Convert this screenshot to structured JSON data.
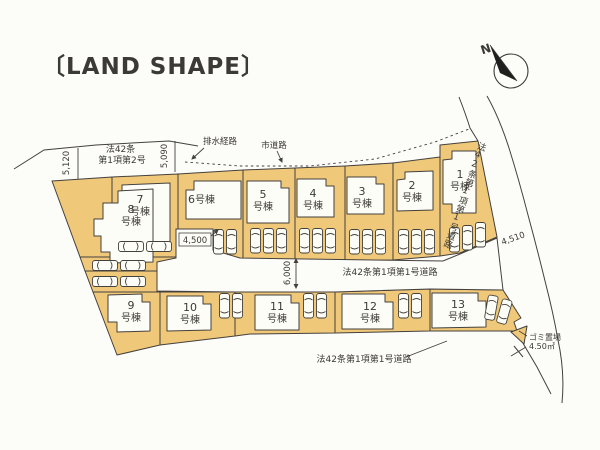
{
  "title": "〔LAND SHAPE〕",
  "compass": {
    "north": "N"
  },
  "roads": {
    "top_law_line1": "法42条",
    "top_law_line2": "第1項第2号",
    "drainage": "排水経路",
    "city_road": "市道路",
    "right_road": "法42条第1項第1号道路",
    "middle_road": "法42条第1項第1号道路",
    "bottom_road": "法42条第1項第1号道路"
  },
  "dimensions": {
    "top_left": "5,120",
    "top_mid": "5,090",
    "mid_left": "4,500",
    "right_junction": "4,510",
    "middle_road_width": "6,000"
  },
  "garbage": {
    "name": "ゴミ置場",
    "area": "4.50㎡"
  },
  "plots": [
    {
      "num": "1",
      "suffix": "号棟"
    },
    {
      "num": "2",
      "suffix": "号棟"
    },
    {
      "num": "3",
      "suffix": "号棟"
    },
    {
      "num": "4",
      "suffix": "号棟"
    },
    {
      "num": "5",
      "suffix": "号棟"
    },
    {
      "num": "6",
      "suffix": "号棟"
    },
    {
      "num": "7",
      "suffix": "号棟"
    },
    {
      "num": "8",
      "suffix": "号棟"
    },
    {
      "num": "9",
      "suffix": "号棟"
    },
    {
      "num": "10",
      "suffix": "号棟"
    },
    {
      "num": "11",
      "suffix": "号棟"
    },
    {
      "num": "12",
      "suffix": "号棟"
    },
    {
      "num": "13",
      "suffix": "号棟"
    }
  ],
  "colors": {
    "plot_fill": "#F0C87A",
    "building_fill": "#FDFDF8",
    "outline": "#44413C",
    "title_text": "#173A73",
    "background": "#FCFCF9"
  }
}
